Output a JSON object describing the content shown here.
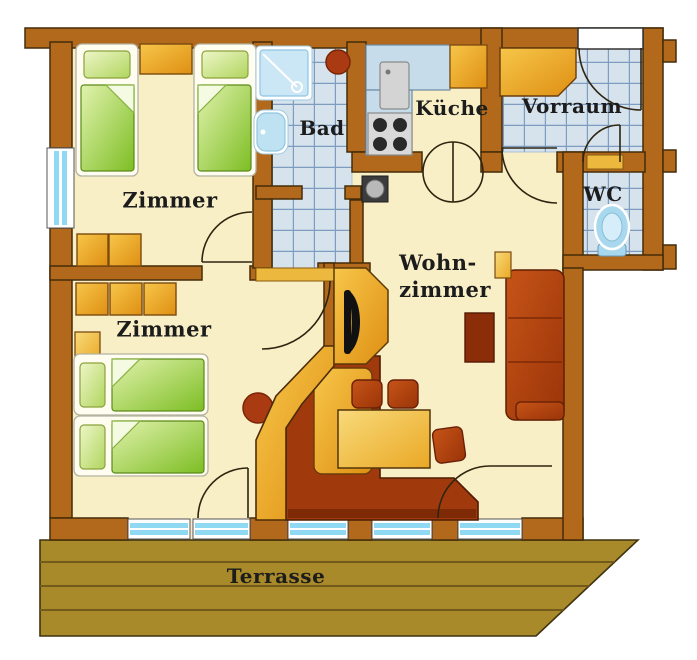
{
  "title": "Apartment floor plan",
  "rooms": {
    "bedroom1": {
      "label": "Zimmer"
    },
    "bedroom2": {
      "label": "Zimmer"
    },
    "bathroom": {
      "label": "Bad"
    },
    "kitchen": {
      "label": "Küche"
    },
    "hallway": {
      "label": "Vorraum"
    },
    "toilet": {
      "label": "WC"
    },
    "living_room": {
      "label_line1": "Wohn-",
      "label_line2": "zimmer"
    },
    "terrace": {
      "label": "Terrasse"
    }
  },
  "colors": {
    "wall": "#b2691c",
    "floor": "#f9efc6",
    "tile": "#d6e3ed",
    "furniture_orange": "#eda72a",
    "bed_green": "#8fc832",
    "upholstery_rust": "#b5491a",
    "terrace_wood": "#a98a2a",
    "window_glass": "#8fd9f2",
    "threshold_gold": "#ecb93e",
    "label_text": "#1c1c1c"
  }
}
